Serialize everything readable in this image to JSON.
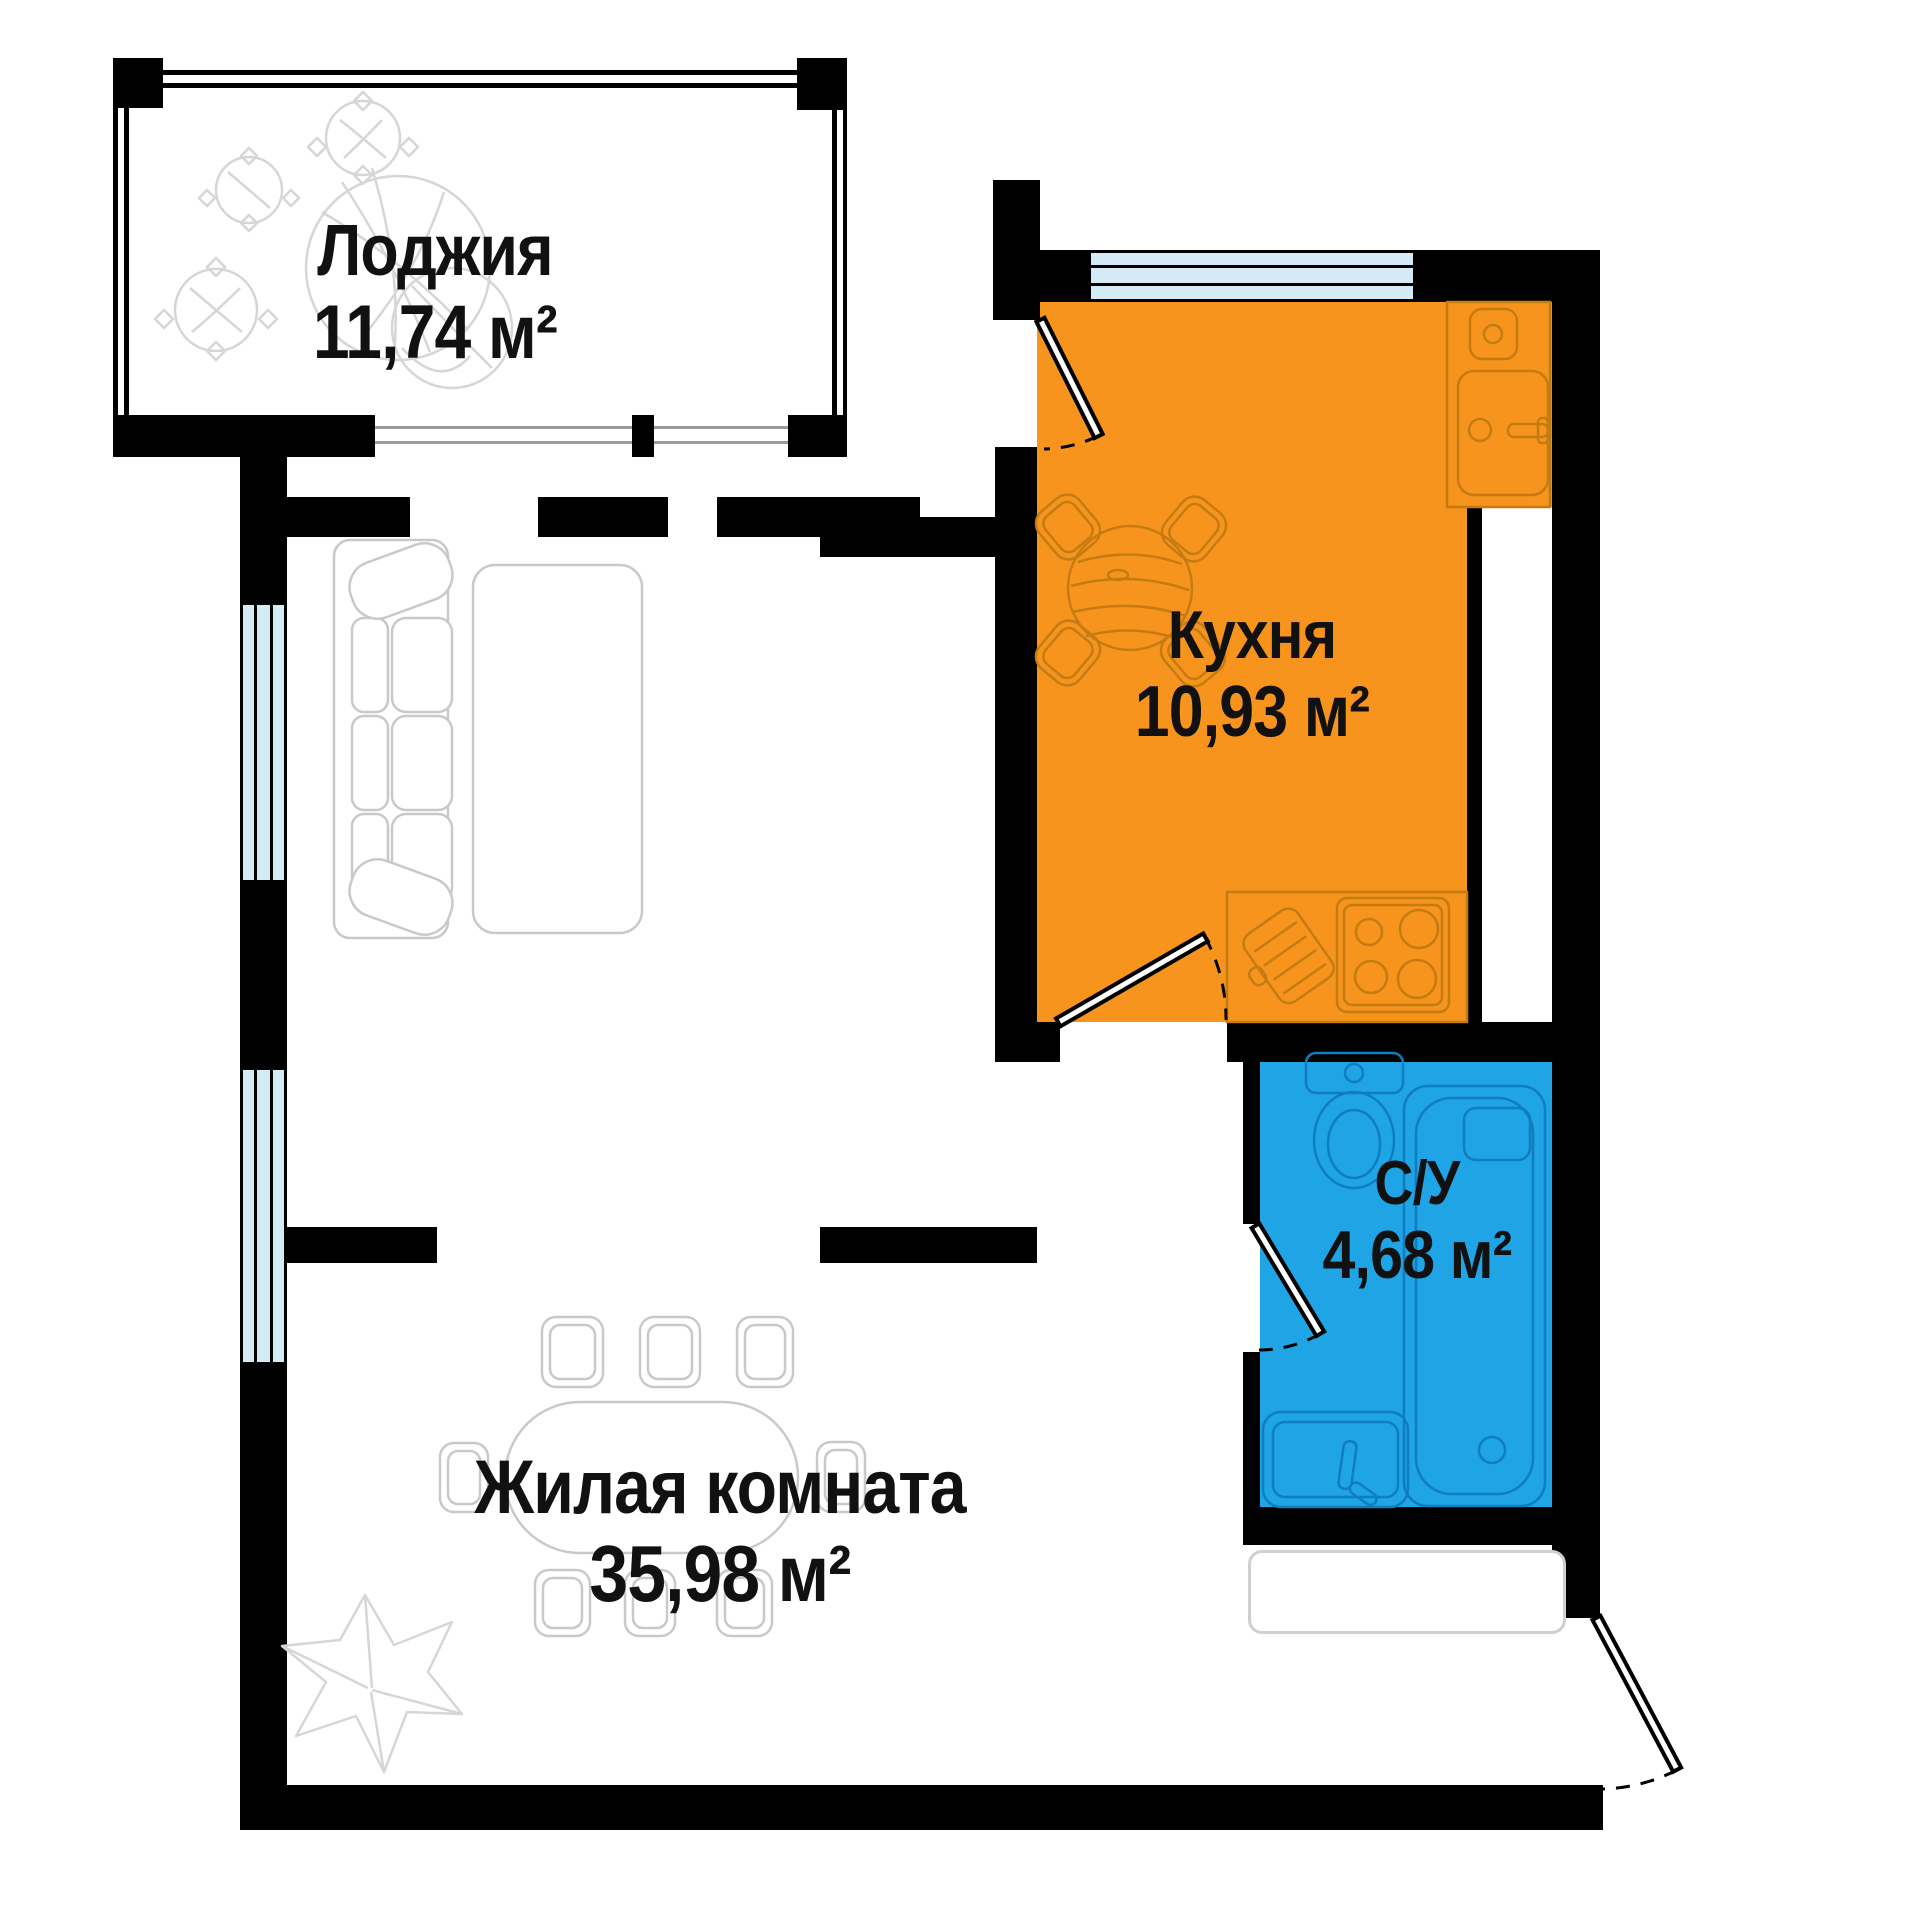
{
  "title": "Apartment floor plan",
  "rooms": {
    "loggia": {
      "name": "Лоджия",
      "area": "11,74 м²"
    },
    "kitchen": {
      "name": "Кухня",
      "area": "10,93 м²"
    },
    "bathroom": {
      "name": "С/У",
      "area": "4,68 м²"
    },
    "living": {
      "name": "Жилая комната",
      "area": "35,98 м²"
    }
  },
  "colors": {
    "kitchen": "#F7941D",
    "bathroom": "#1FA5E6",
    "window": "#D4EAF4",
    "wall": "#000000",
    "furniture_gray": "#C9C9CD",
    "furniture_orange": "#C47C12",
    "furniture_blue": "#0F7DBE",
    "plant": "#D6D6D6",
    "text": "#111111",
    "bg": "#FFFFFF"
  },
  "icons": {
    "window-icon": "striped light-blue band",
    "door-icon": "swing leaf with dashed arc",
    "sofa-icon": "outlined sofa with cushions",
    "rug-icon": "rounded rectangle outline",
    "dining-table-icon": "stadium shape with chairs",
    "chair-icon": "double rounded square",
    "kitchen-table-icon": "round wooden table with 4 chairs",
    "sink-icon": "counter with basins and faucet",
    "stove-icon": "hob with 4 burners",
    "cutting-board-icon": "hatched board",
    "toilet-icon": "tank and bowl",
    "washbasin-icon": "basin with faucet",
    "bathtub-icon": "tub with drain",
    "plant-icon": "decorative foliage",
    "flower-icon": "leaf star",
    "closet-icon": "rounded wardrobe outline"
  }
}
